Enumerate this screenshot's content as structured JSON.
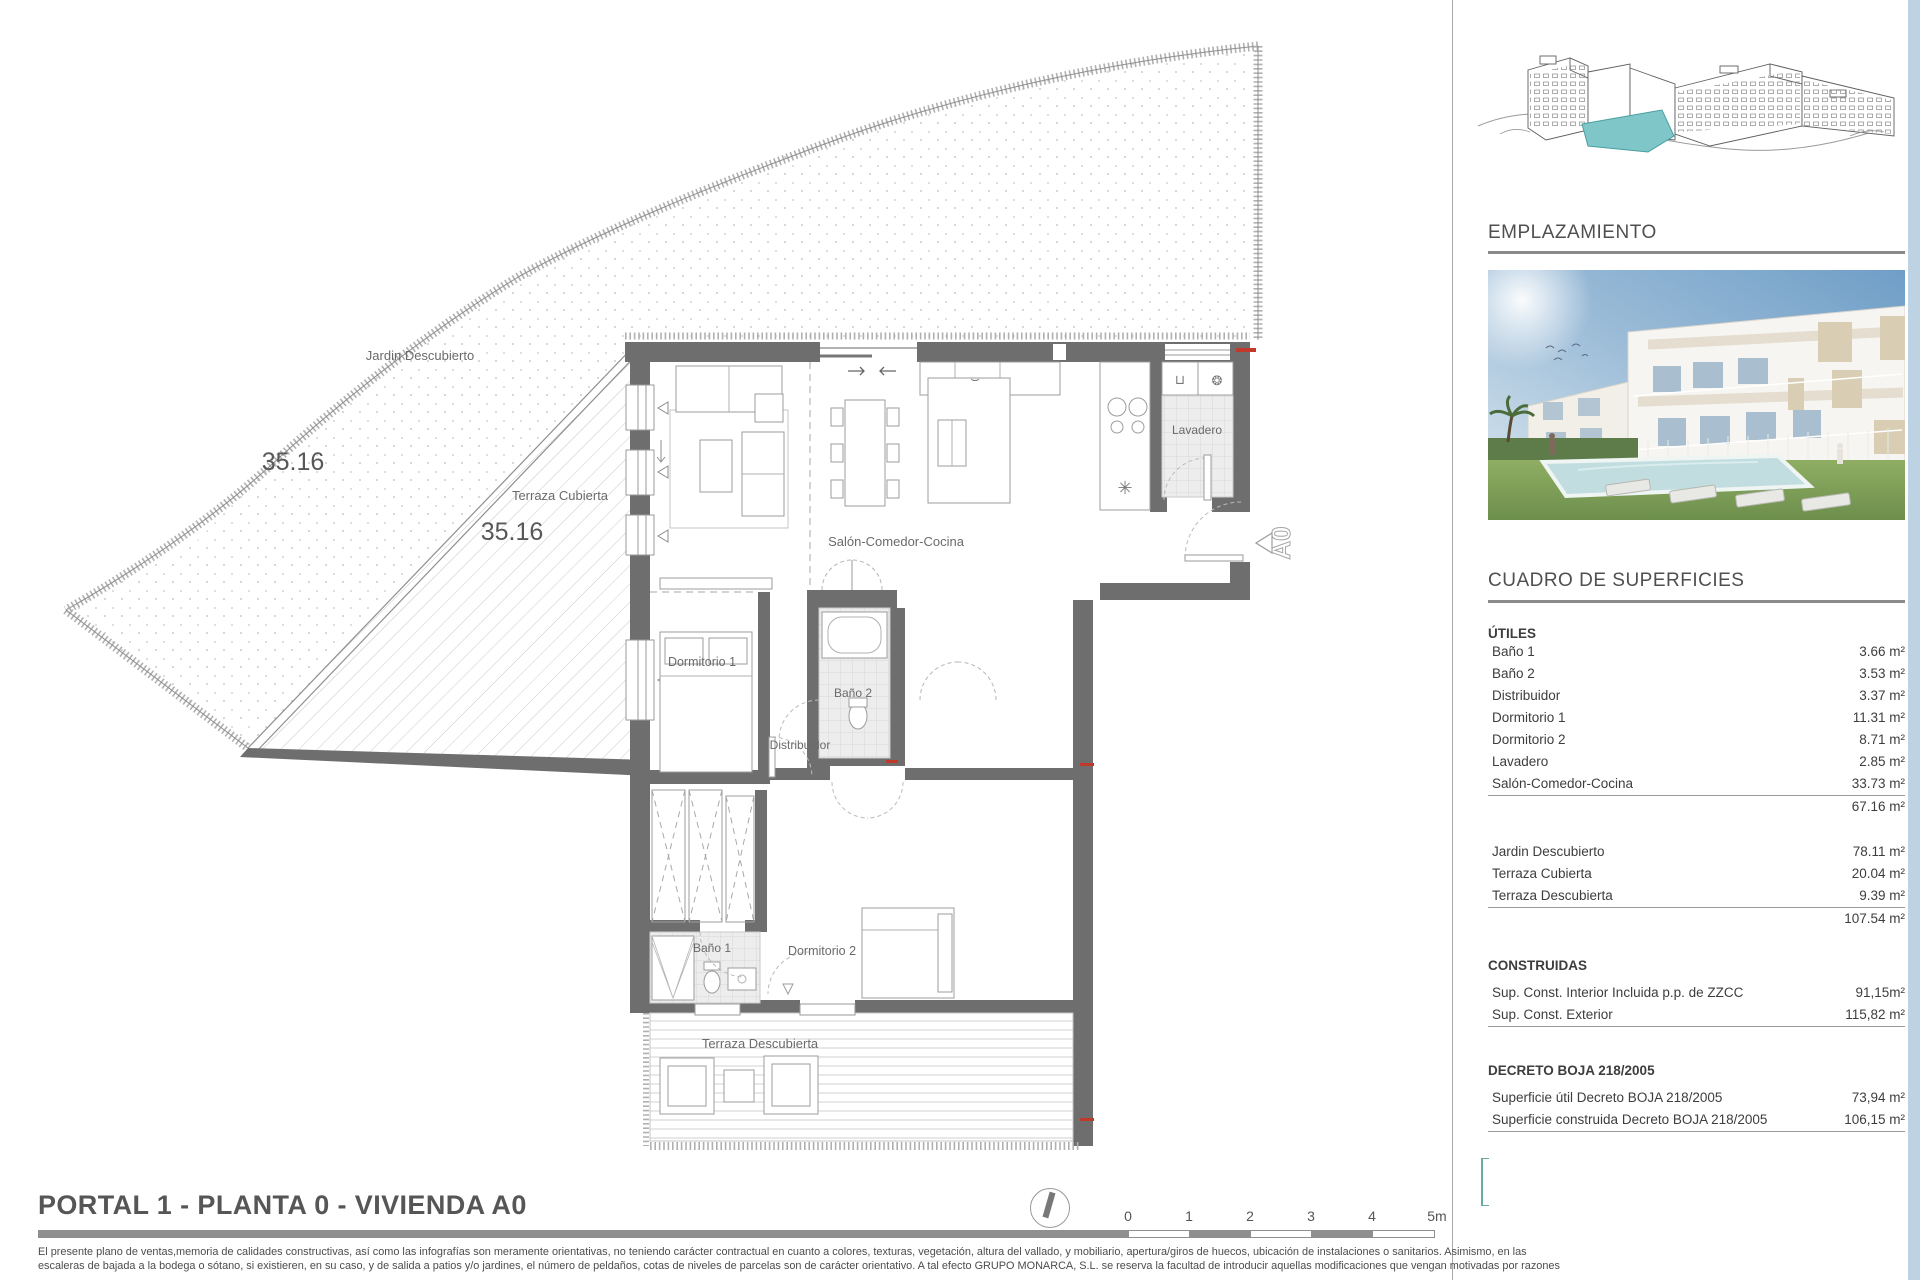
{
  "plan": {
    "labels": {
      "jardin": "Jardin Descubierto",
      "jardin_area": "35.16",
      "terraza_cubierta": "Terraza Cubierta",
      "terraza_cubierta_area": "35.16",
      "salon": "Salón-Comedor-Cocina",
      "lavadero": "Lavadero",
      "dormitorio1": "Dormitorio 1",
      "bano2": "Baño 2",
      "distribuidor": "Distribuidor",
      "bano1": "Baño 1",
      "dormitorio2": "Dormitorio 2",
      "terraza_descubierta": "Terraza Descubierta",
      "unit_marker": "A0"
    }
  },
  "sidebar": {
    "emplazamiento_heading": "EMPLAZAMIENTO",
    "cuadro_heading": "CUADRO DE SUPERFICIES",
    "utiles_heading": "ÚTILES",
    "utiles_rows": [
      {
        "label": "Baño 1",
        "value": "3.66 m²"
      },
      {
        "label": "Baño 2",
        "value": "3.53 m²"
      },
      {
        "label": "Distribuidor",
        "value": "3.37 m²"
      },
      {
        "label": "Dormitorio 1",
        "value": "11.31 m²"
      },
      {
        "label": "Dormitorio 2",
        "value": "8.71 m²"
      },
      {
        "label": "Lavadero",
        "value": "2.85 m²"
      },
      {
        "label": "Salón-Comedor-Cocina",
        "value": "33.73 m²"
      }
    ],
    "utiles_subtotal": "67.16 m²",
    "exterior_rows": [
      {
        "label": "Jardin Descubierto",
        "value": "78.11 m²"
      },
      {
        "label": "Terraza Cubierta",
        "value": "20.04 m²"
      },
      {
        "label": "Terraza Descubierta",
        "value": "9.39 m²"
      }
    ],
    "exterior_subtotal": "107.54 m²",
    "construidas_heading": "CONSTRUIDAS",
    "construidas_rows": [
      {
        "label": "Sup. Const. Interior Incluida p.p. de ZZCC",
        "value": "91,15m²"
      },
      {
        "label": "Sup. Const. Exterior",
        "value": "115,82 m²"
      }
    ],
    "decreto_heading": "DECRETO BOJA 218/2005",
    "decreto_rows": [
      {
        "label": "Superficie útil Decreto BOJA 218/2005",
        "value": "73,94 m²"
      },
      {
        "label": "Superficie construida Decreto BOJA 218/2005",
        "value": "106,15 m²"
      }
    ]
  },
  "footer": {
    "title": "PORTAL 1 - PLANTA 0 - VIVIENDA A0",
    "scale_labels": [
      "0",
      "1",
      "2",
      "3",
      "4",
      "5m"
    ],
    "disclaimer_line1": "El presente plano de ventas,memoria de calidades constructivas, así como las infografías son meramente orientativas, no teniendo carácter contractual en cuanto a colores, texturas, vegetación, altura del vallado, y mobiliario, apertura/giros de huecos, ubicación de instalaciones o sanitarios. Asimismo, en las",
    "disclaimer_line2": "escaleras de bajada a la bodega o sótano, si existieren, en su caso, y de salida a patios y/o jardines, el número de peldaños, cotas de niveles de parcelas son de carácter orientativo. A tal efecto GRUPO MONARCA, S.L.  se reserva la facultad de introducir aquellas modificaciones que vengan motivadas por razones"
  },
  "colors": {
    "wall": "#6e6e6e",
    "accent_teal": "#7fc6c9",
    "accent_red": "#c0392b",
    "heading_gray": "#4f4f4f",
    "edge_blue": "#bdd2e2"
  }
}
